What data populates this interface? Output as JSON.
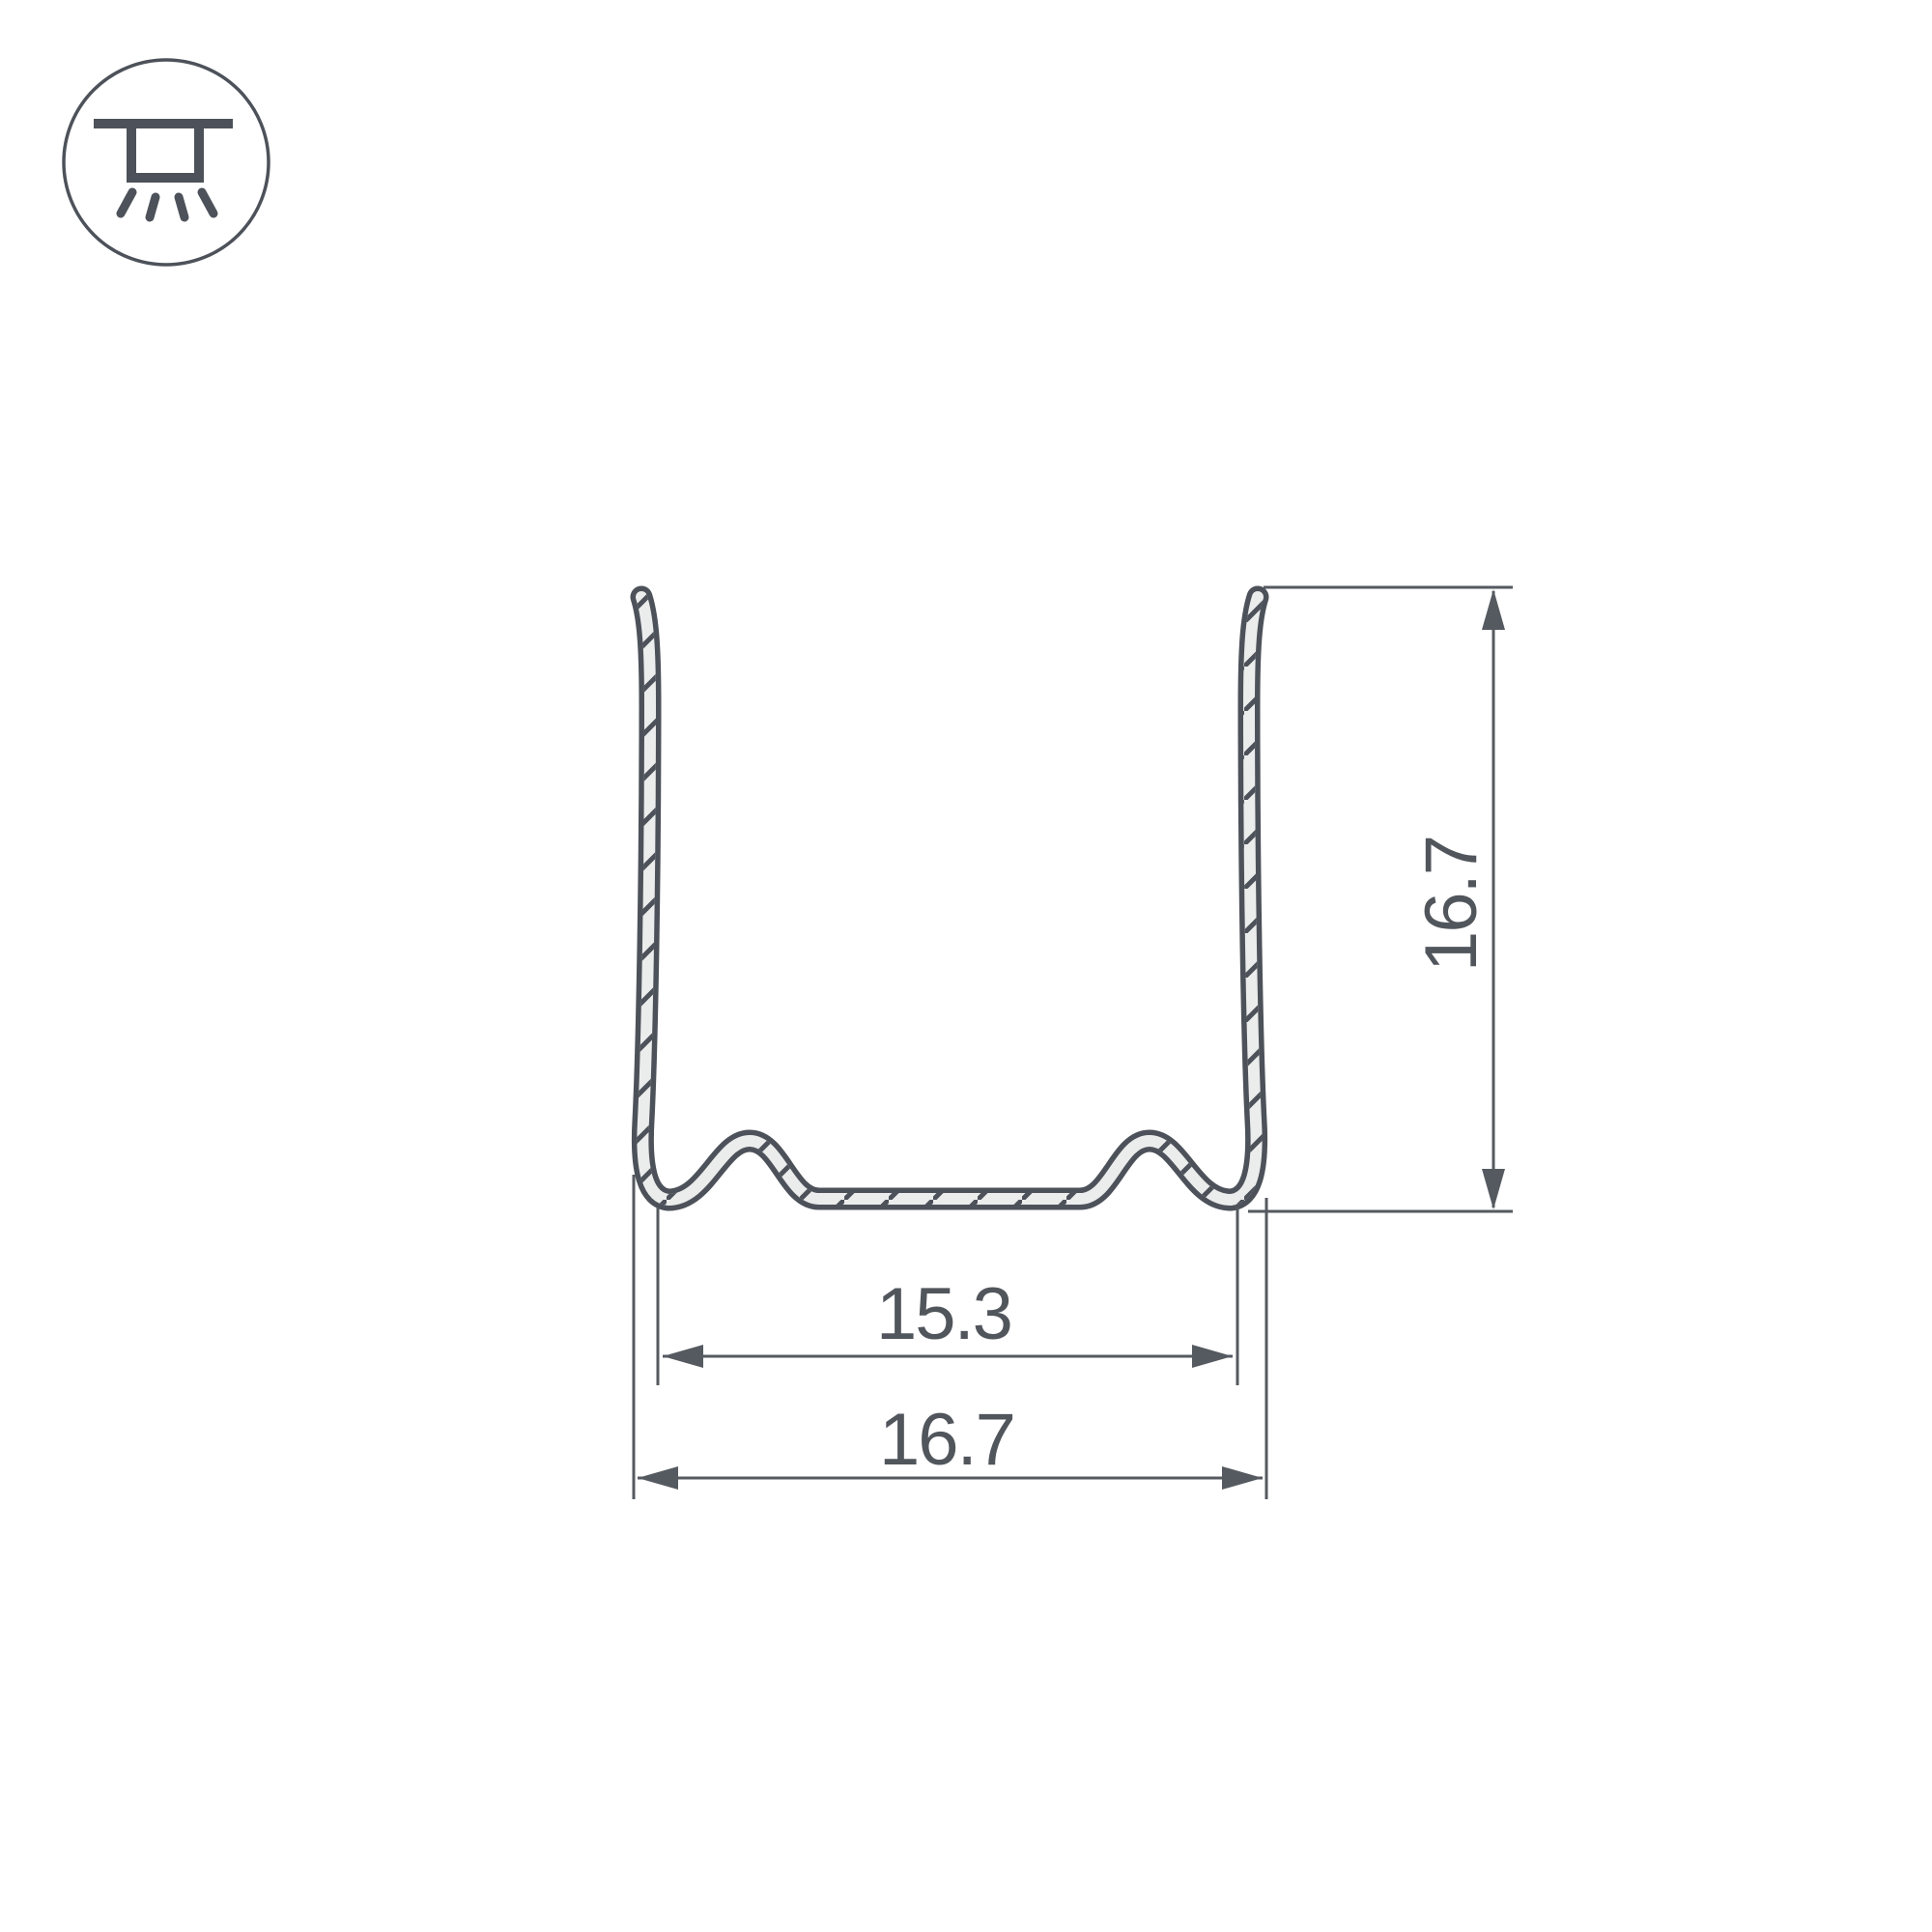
{
  "icon": {
    "name": "ceiling-light-icon",
    "description": "recessed ceiling light fixture symbol in circle"
  },
  "drawing": {
    "type": "profile-cross-section-diagram",
    "dimensions": {
      "inner_width_label": "15.3",
      "outer_width_label": "16.7",
      "height_label": "16.7"
    }
  },
  "colors": {
    "outline": "#4d525a",
    "fill": "#ebecec",
    "dims": "#555a60",
    "text": "#51565c",
    "background": "#ffffff"
  }
}
